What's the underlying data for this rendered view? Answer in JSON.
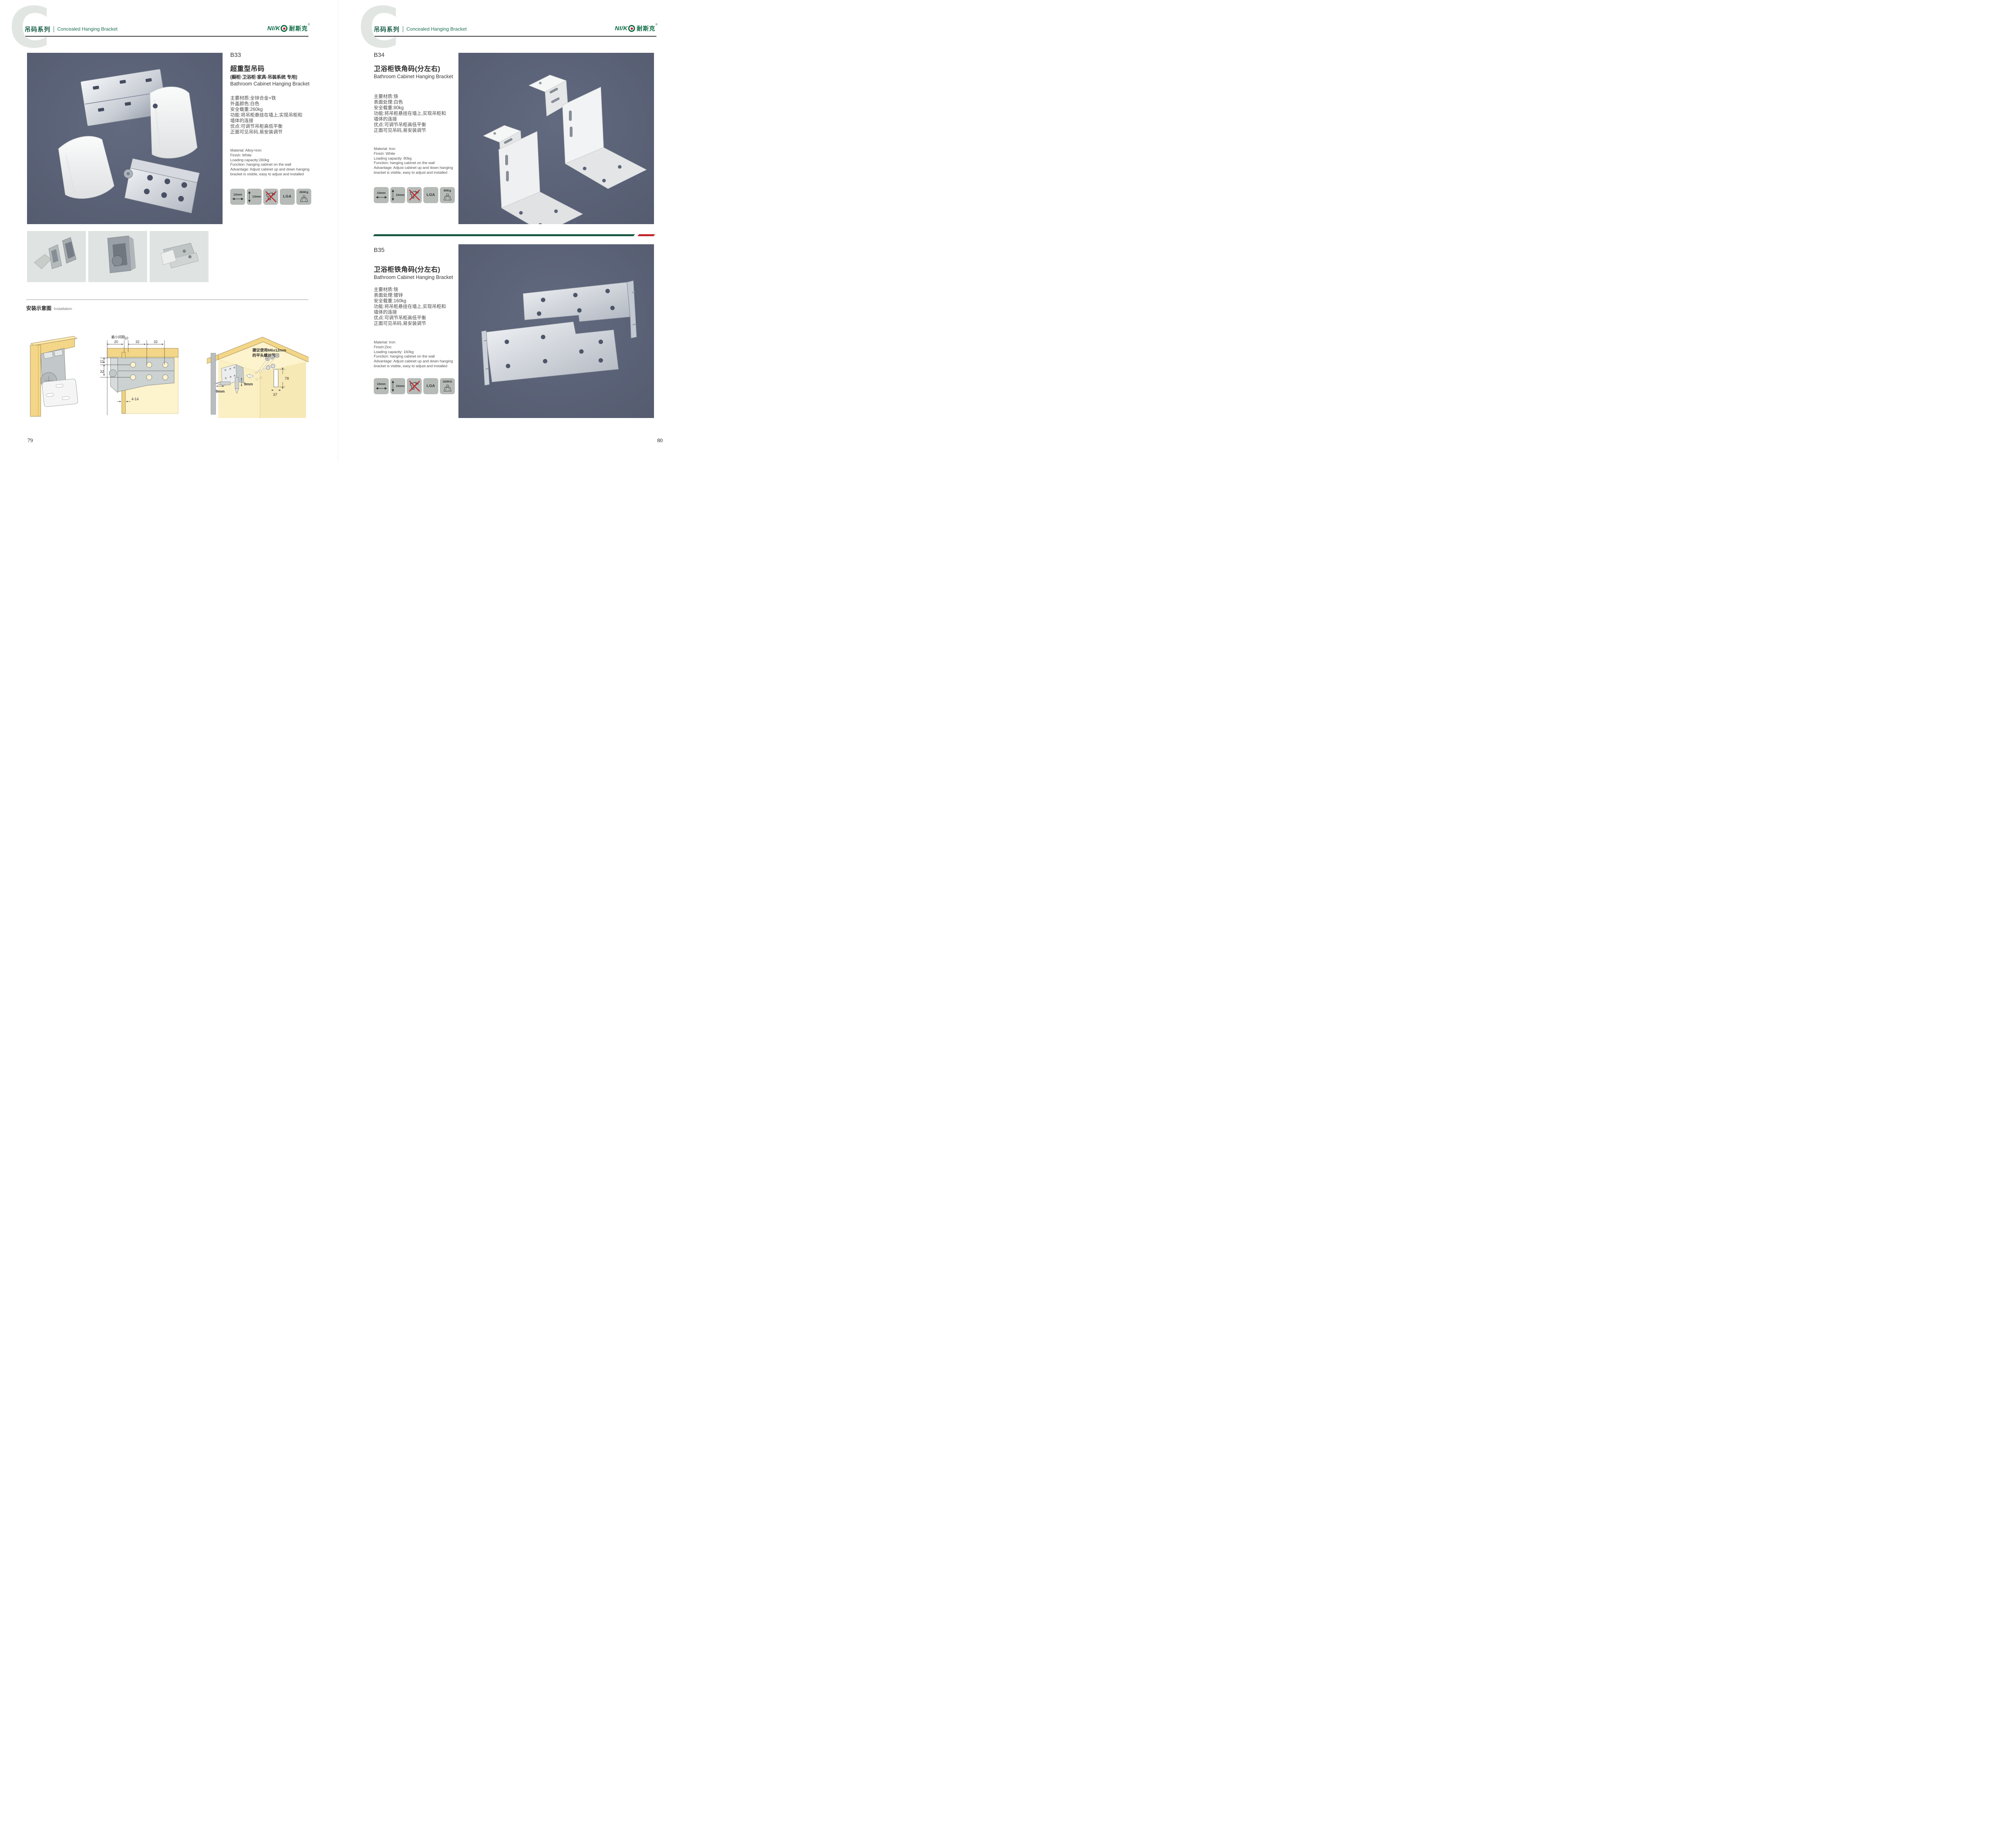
{
  "header": {
    "watermark": "C",
    "series_cn": "吊码系列",
    "series_en": "Concealed Hanging Bracket"
  },
  "brand": {
    "latin": "NI/K",
    "cn": "耐斯克",
    "reg": "®"
  },
  "products": {
    "b33": {
      "code": "B33",
      "title_cn": "超重型吊码",
      "note": "(橱柜·卫浴柜·家具·吊装系统 专用)",
      "title_en": "Bathroom Cabinet Hanging Bracket",
      "specs_cn": [
        "主要材质:全锌合金+铁",
        "外盖颜色:白色",
        "安全载重:260kg",
        "功能:将吊柜悬挂在墙上,实现吊柜和",
        "墙体的连接",
        "优点:可调节吊柜高低平衡",
        "正面可见吊码,易安装调节"
      ],
      "specs_en": [
        "Material: Alloy+iron",
        "Finish: White",
        "Loading capacity:260kg",
        "Function: hanging cabinet on the wall",
        "Advantage: Adjust cabinet up and down hanging",
        "bracket is visible, easy to adjust and installed"
      ],
      "icons": {
        "width": "12mm",
        "height": "13mm",
        "cert": "LGA",
        "load": "260Kg"
      }
    },
    "b34": {
      "code": "B34",
      "title_cn": "卫浴柜铁角码(分左右)",
      "title_en": "Bathroom Cabinet Hanging Bracket",
      "specs_cn": [
        "主要材质:铁",
        "表面处理:白色",
        "安全载重:80kg",
        "功能:将吊柜悬挂在墙上,实现吊柜和",
        "墙体的连接",
        "优点:可调节吊柜高低平衡",
        "正面可见吊码,易安装调节"
      ],
      "specs_en": [
        "Material: Iron",
        "Finish: White",
        "Loading capacity: 80kg",
        "Function: hanging cabinet on the wall",
        "Advantage: Adjust cabinet up and down hanging",
        "bracket is visible, easy to adjust and installed"
      ],
      "icons": {
        "width": "10mm",
        "height": "15mm",
        "cert": "LGA",
        "load": "80Kg"
      }
    },
    "b35": {
      "code": "B35",
      "title_cn": "卫浴柜铁角码(分左右)",
      "title_en": "Bathroom Cabinet Hanging Bracket",
      "specs_cn": [
        "主要材质:铁",
        "表面处理:镀锌",
        "安全载重:160kg",
        "功能:将吊柜悬挂在墙上,实现吊柜和",
        "墙体的连接",
        "优点:可调节吊柜高低平衡",
        "正面可见吊码,易安装调节"
      ],
      "specs_en": [
        "Material: Iron",
        "Finish:Zinc",
        "Loading capacity: 160kg",
        "Function: hanging cabinet on the wall",
        "Advantage: Adjust cabinet up and down hanging",
        "bracket is visible, easy to adjust and installed"
      ],
      "icons": {
        "width": "10mm",
        "height": "15mm",
        "cert": "LGA",
        "load": "160KG"
      }
    }
  },
  "installation": {
    "title_cn": "安装示意图",
    "title_en": "Installation",
    "d2": {
      "min_label": "最小间距",
      "dim_20": "20",
      "dim_10": "10",
      "dim_32a": "32",
      "dim_32b": "32",
      "dim_11": "11",
      "dim_32c": "32",
      "dim_414": "4-14"
    },
    "d3": {
      "note1": "建议使用M6x12mm",
      "note2": "的平头螺丝固定",
      "dim_78": "78",
      "dim_37": "37",
      "dim_9a": "9mm",
      "dim_9b": "9mm"
    }
  },
  "pages": {
    "left": "79",
    "right": "80"
  }
}
